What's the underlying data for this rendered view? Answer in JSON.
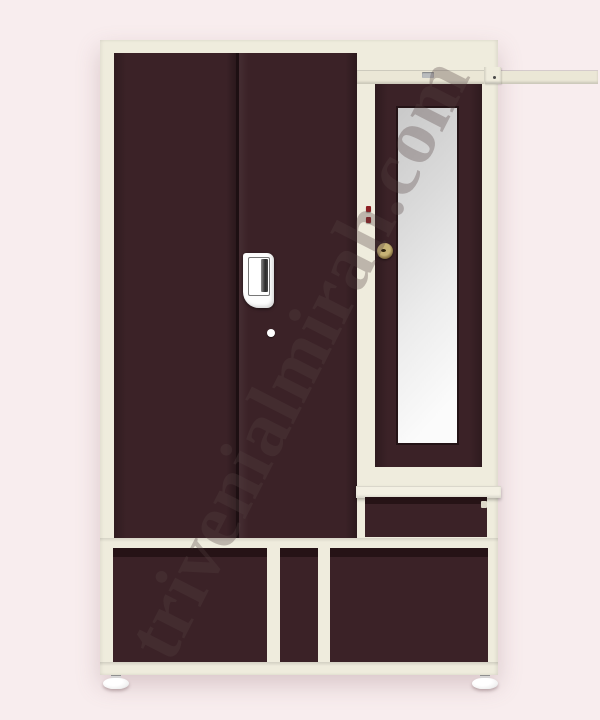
{
  "watermark": {
    "text": "trivenialmirah.com"
  },
  "colors": {
    "bg": "#f8edee",
    "cream": "#efecdd",
    "cream-under": "#ebe7d6",
    "brown": "#3b2227",
    "brown-groove": "#261316",
    "seam": "#1d0f12",
    "mirror-frame": "#241316",
    "mirror-dark": "#c9c9c9",
    "mirror-light": "#fbfbfb",
    "brass": "#c7b376",
    "brass-dark": "#6f5a2e",
    "hinge-red": "#8d2024",
    "handle-white": "#fdfdfd",
    "foot": "#f2f2f2",
    "watermark-color": "rgba(84,64,66,0.32)"
  }
}
